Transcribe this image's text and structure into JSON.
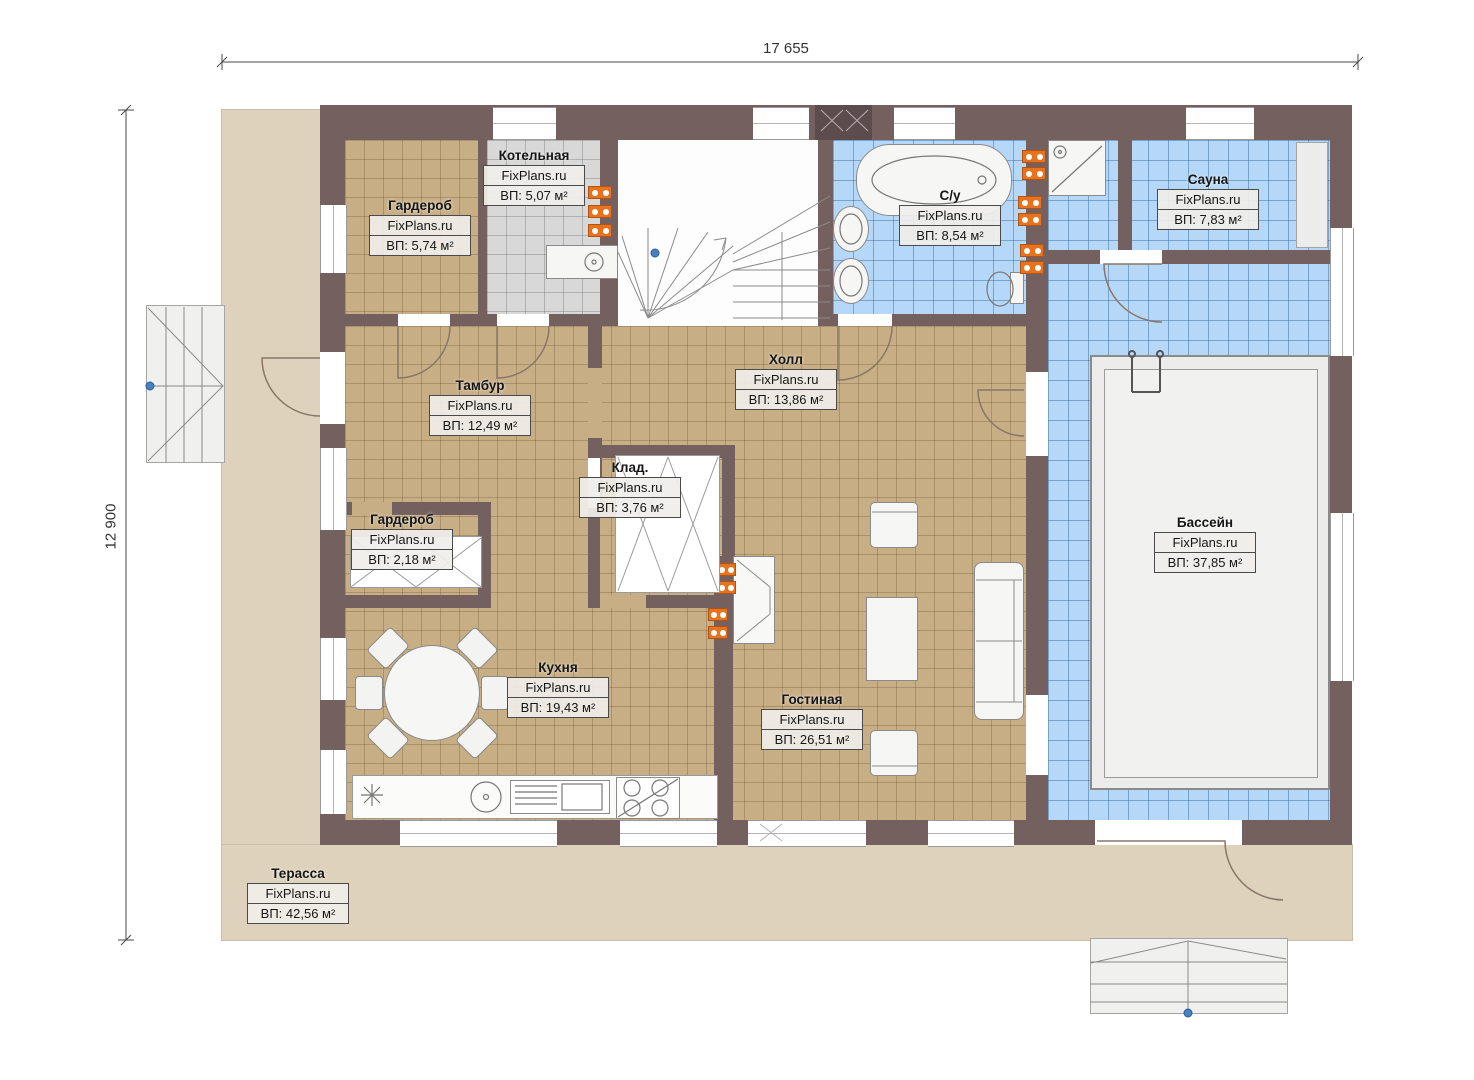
{
  "plan": {
    "brand_watermark": "FixPlans.ru",
    "dimensions": {
      "width_label": "17 655",
      "height_label": "12 900"
    },
    "colors": {
      "wall": "#74605f",
      "floorDry": "#c8ae85",
      "floorWet": "#b5d8f8",
      "floorUtil": "#d8d8d8",
      "terrace": "#ded2bc",
      "radiator": "#e8731e",
      "marker": "#4a7fc1"
    },
    "rooms": [
      {
        "id": "garderob-top",
        "name": "Гардероб",
        "watermark": "FixPlans.ru",
        "area": "ВП: 5,74 м²"
      },
      {
        "id": "kotelnaya",
        "name": "Котельная",
        "watermark": "FixPlans.ru",
        "area": "ВП: 5,07 м²"
      },
      {
        "id": "su",
        "name": "С/у",
        "watermark": "FixPlans.ru",
        "area": "ВП: 8,54 м²"
      },
      {
        "id": "sauna",
        "name": "Сауна",
        "watermark": "FixPlans.ru",
        "area": "ВП: 7,83 м²"
      },
      {
        "id": "tambur",
        "name": "Тамбур",
        "watermark": "FixPlans.ru",
        "area": "ВП: 12,49 м²"
      },
      {
        "id": "holl",
        "name": "Холл",
        "watermark": "FixPlans.ru",
        "area": "ВП: 13,86 м²"
      },
      {
        "id": "klad",
        "name": "Клад.",
        "watermark": "FixPlans.ru",
        "area": "ВП: 3,76 м²"
      },
      {
        "id": "garderob-mid",
        "name": "Гардероб",
        "watermark": "FixPlans.ru",
        "area": "ВП: 2,18 м²"
      },
      {
        "id": "kuhnya",
        "name": "Кухня",
        "watermark": "FixPlans.ru",
        "area": "ВП: 19,43 м²"
      },
      {
        "id": "gostinaya",
        "name": "Гостиная",
        "watermark": "FixPlans.ru",
        "area": "ВП: 26,51 м²"
      },
      {
        "id": "bassein",
        "name": "Бассейн",
        "watermark": "FixPlans.ru",
        "area": "ВП: 37,85 м²"
      },
      {
        "id": "terrassa",
        "name": "Терасса",
        "watermark": "FixPlans.ru",
        "area": "ВП: 42,56 м²"
      }
    ]
  }
}
